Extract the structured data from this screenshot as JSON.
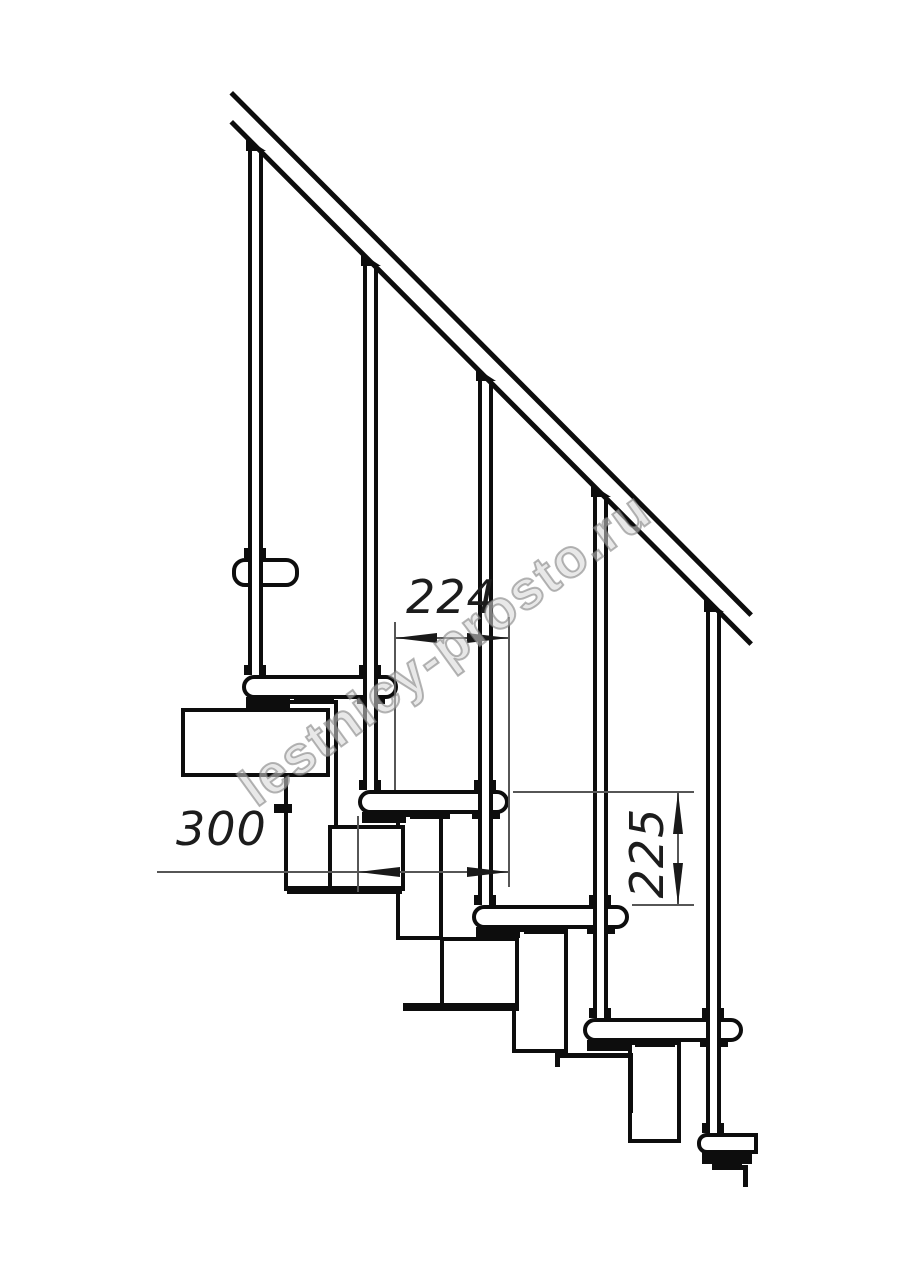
{
  "title": "Modular staircase side elevation - technical line drawing",
  "watermark": {
    "text": "lestnicy-prosto.ru"
  },
  "dimensions": {
    "tread_pitch": {
      "value": "224",
      "orientation": "horizontal",
      "measures": "horizontal spacing between adjacent balusters (step pitch)"
    },
    "tread_depth": {
      "value": "300",
      "orientation": "horizontal",
      "measures": "tread depth"
    },
    "step_rise": {
      "value": "225",
      "orientation": "vertical",
      "measures": "rise between tops of consecutive treads"
    }
  },
  "drawing": {
    "style": "black line art on white background",
    "handrail": "straight sloped handrail of two parallel lines, upper-left to lower-right",
    "balusters_visible": 5,
    "treads_visible": 6,
    "support": "modular central stringer of rectangular blocks under each tread"
  },
  "colors": {
    "line": "#0d0d0d",
    "thin_line": "#565656",
    "text": "#1c1c1c",
    "watermark_gray": "#d6d6d6"
  }
}
